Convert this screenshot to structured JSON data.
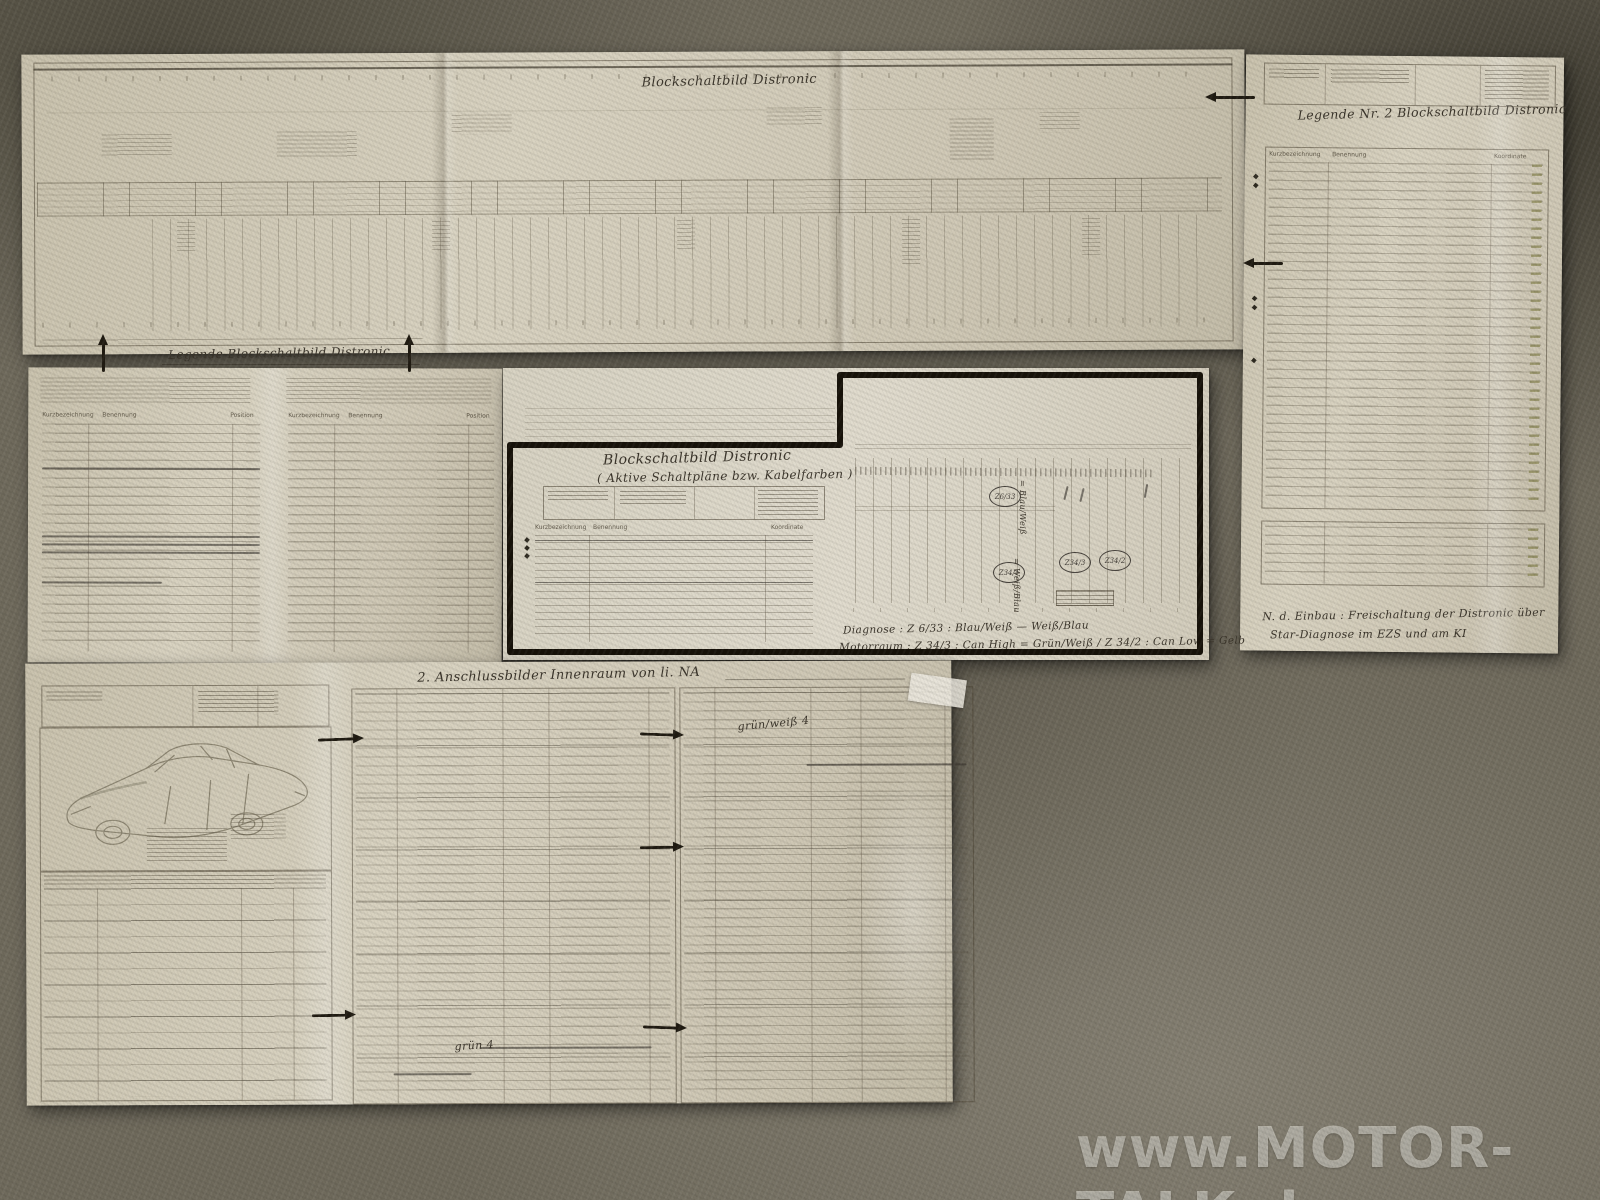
{
  "photo": {
    "description": "Wiring diagram printouts for a Distronic retrofit laid out on carpet",
    "watermark": "www.MOTOR-TALK.de"
  },
  "colors": {
    "carpet": "#6f6a5c",
    "paper": "#d3ccb9",
    "marker_frame": "#171209",
    "handwriting_ink": "#3a342a",
    "green_ink": "#787a3a",
    "watermark": "#e9e7de"
  },
  "handwriting": {
    "top_sheet_title": "Blockschaltbild Distronic",
    "right_sheet_title": "Legende Nr. 2  Blockschaltbild Distronic",
    "left_sheet_title": "Legende Blockschaltbild Distronic",
    "framed_title_line1": "Blockschaltbild Distronic",
    "framed_title_line2": "( Aktive Schaltpläne bzw. Kabelfarben )",
    "diagnose_note_line1": "Diagnose : Z 6/33 : Blau/Weiß  —  Weiß/Blau",
    "diagnose_note_line2": "Motorraum : Z 34/3 : Can High = Grün/Weiß   /   Z 34/2 : Can Low = Gelb",
    "retrofit_note_line1": "N. d. Einbau : Freischaltung der Distronic über",
    "retrofit_note_line2": "Star-Diagnose im EZS und am KI",
    "bottom_sheet_title": "2. Anschlussbilder Innenraum  von li. NA",
    "wire_color_note_1": "grün/weiß  4",
    "wire_color_note_2": "grün  4",
    "circle_label_1": "Z6/33",
    "circle_label_2": "Z34/1",
    "circle_label_3": "Z34/3",
    "circle_label_4": "Z34/2",
    "vertical_note_1": "= Blau/Weiß",
    "vertical_note_2": "= Weiß/Blau"
  },
  "print_headers": {
    "kurzbezeichnung": "Kurzbezeichnung",
    "benennung": "Benennung",
    "position": "Position",
    "koordinate": "Koordinate"
  }
}
